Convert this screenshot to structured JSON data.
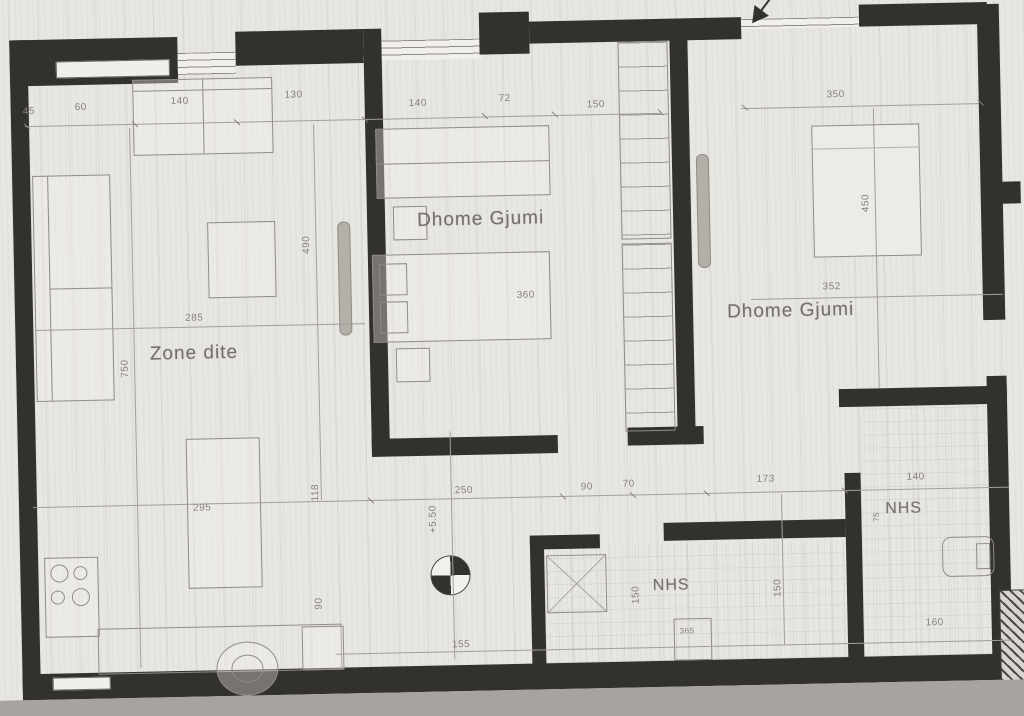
{
  "meta": {
    "title": "Apartment floor plan (scanned)"
  },
  "plan": {
    "room_labels": {
      "zone_dite": "Zone dite",
      "bedroom_center": "Dhome Gjumi",
      "bedroom_right": "Dhome Gjumi",
      "bath_center": "NHS",
      "bath_right": "NHS"
    },
    "level_annotation": "+5.50",
    "dimensions": {
      "top": {
        "d45": "45",
        "d60": "60",
        "d140_sofa": "140",
        "d130": "130",
        "d140_bed": "140",
        "d72": "72",
        "d150": "150",
        "d350": "350"
      },
      "vertical": {
        "d750": "750",
        "d490": "490",
        "d450": "450",
        "d118": "118",
        "d90_left": "90",
        "d150_bath_left": "150",
        "d150_bath_right": "150",
        "d75_bath_right": "75"
      },
      "middle": {
        "d285": "285",
        "d295": "295",
        "d360": "360",
        "d352": "352",
        "d250": "250",
        "d90": "90",
        "d70": "70",
        "d173": "173",
        "d140_bath": "140"
      },
      "bottom": {
        "d155": "155",
        "d365": "365",
        "d160": "160"
      }
    }
  }
}
